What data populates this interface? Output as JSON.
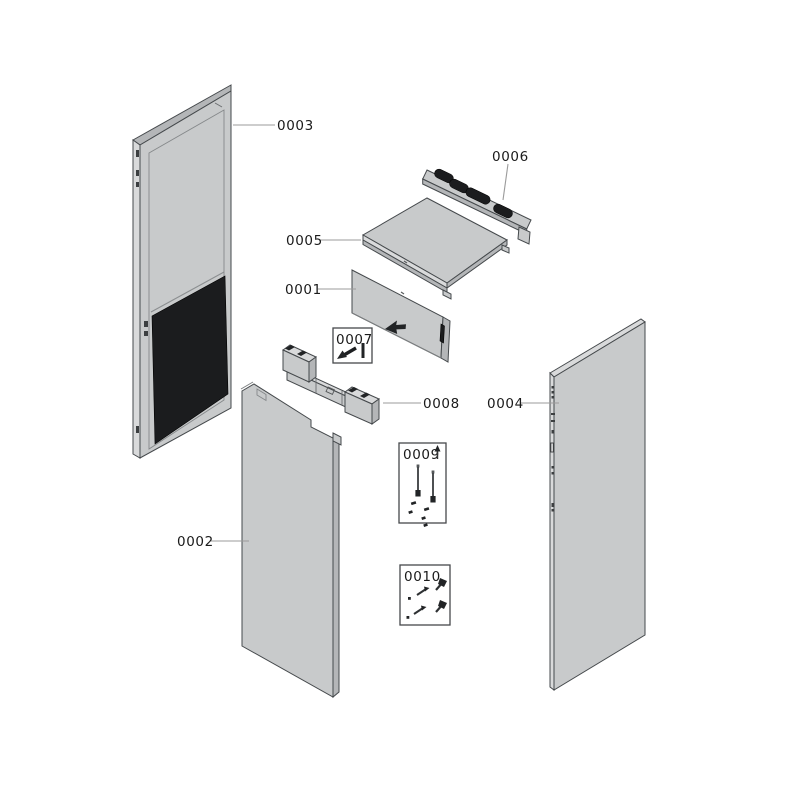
{
  "diagram": {
    "labels": {
      "p0001": "0001",
      "p0002": "0002",
      "p0003": "0003",
      "p0004": "0004",
      "p0005": "0005",
      "p0006": "0006",
      "p0007": "0007",
      "p0008": "0008",
      "p0009": "0009",
      "p0010": "0010"
    },
    "colors": {
      "background": "#ffffff",
      "panel_fill": "#c8cacb",
      "panel_edge_light": "#d9dadb",
      "panel_edge_shaded": "#b4b6b8",
      "outline": "#45494c",
      "dark_part": "#1b1c1e",
      "leader_line": "#9b9b9b",
      "label_text": "#1b1b1b"
    }
  }
}
